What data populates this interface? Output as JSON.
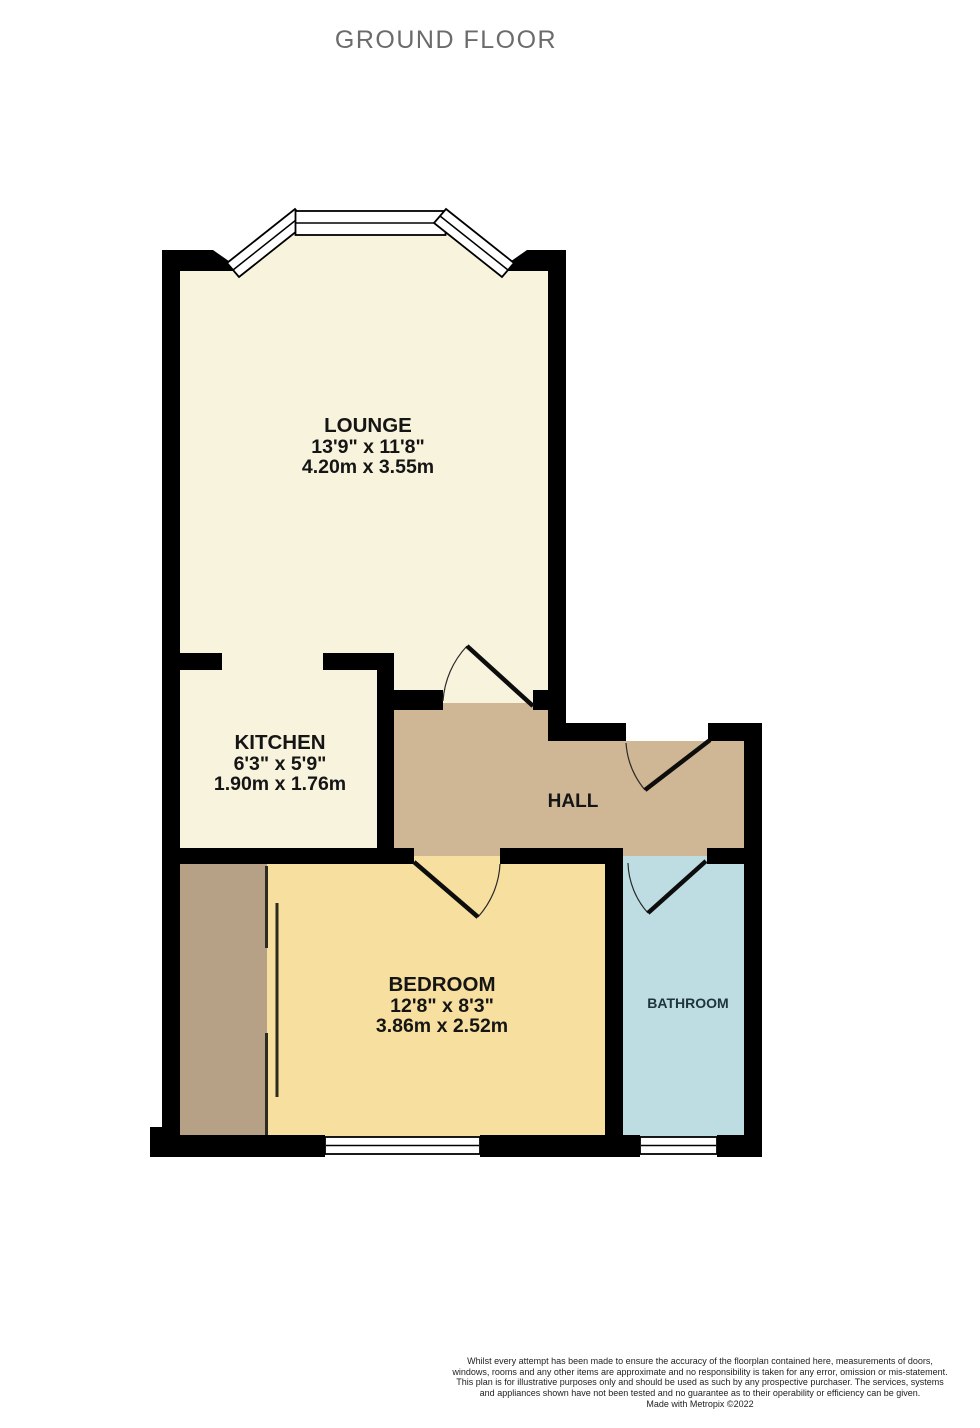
{
  "title": "GROUND FLOOR",
  "colors": {
    "wall": "#000000",
    "cream": "#f8f3dc",
    "hall": "#cfb695",
    "wardrobe": "#b7a186",
    "bedroom": "#f6df9f",
    "bathroom": "#bddde3",
    "title_text": "#6b6b6b",
    "label_text": "#151515"
  },
  "rooms": {
    "lounge": {
      "name": "LOUNGE",
      "imperial": "13'9\"  x 11'8\"",
      "metric": "4.20m  x 3.55m"
    },
    "kitchen": {
      "name": "KITCHEN",
      "imperial": "6'3\"  x 5'9\"",
      "metric": "1.90m  x 1.76m"
    },
    "hall": {
      "name": "HALL"
    },
    "bedroom": {
      "name": "BEDROOM",
      "imperial": "12'8\"  x 8'3\"",
      "metric": "3.86m  x 2.52m"
    },
    "bathroom": {
      "name": "BATHROOM"
    }
  },
  "footer": {
    "disclaimer": "Whilst every attempt has been made to ensure the accuracy of the floorplan contained here, measurements of doors, windows, rooms and any other items are approximate and no responsibility is taken for any error, omission or mis-statement. This plan is for illustrative purposes only and should be used as such by any prospective purchaser. The services, systems and appliances shown have not been tested and no guarantee as to their operability or efficiency can be given.",
    "credit": "Made with Metropix ©2022"
  }
}
